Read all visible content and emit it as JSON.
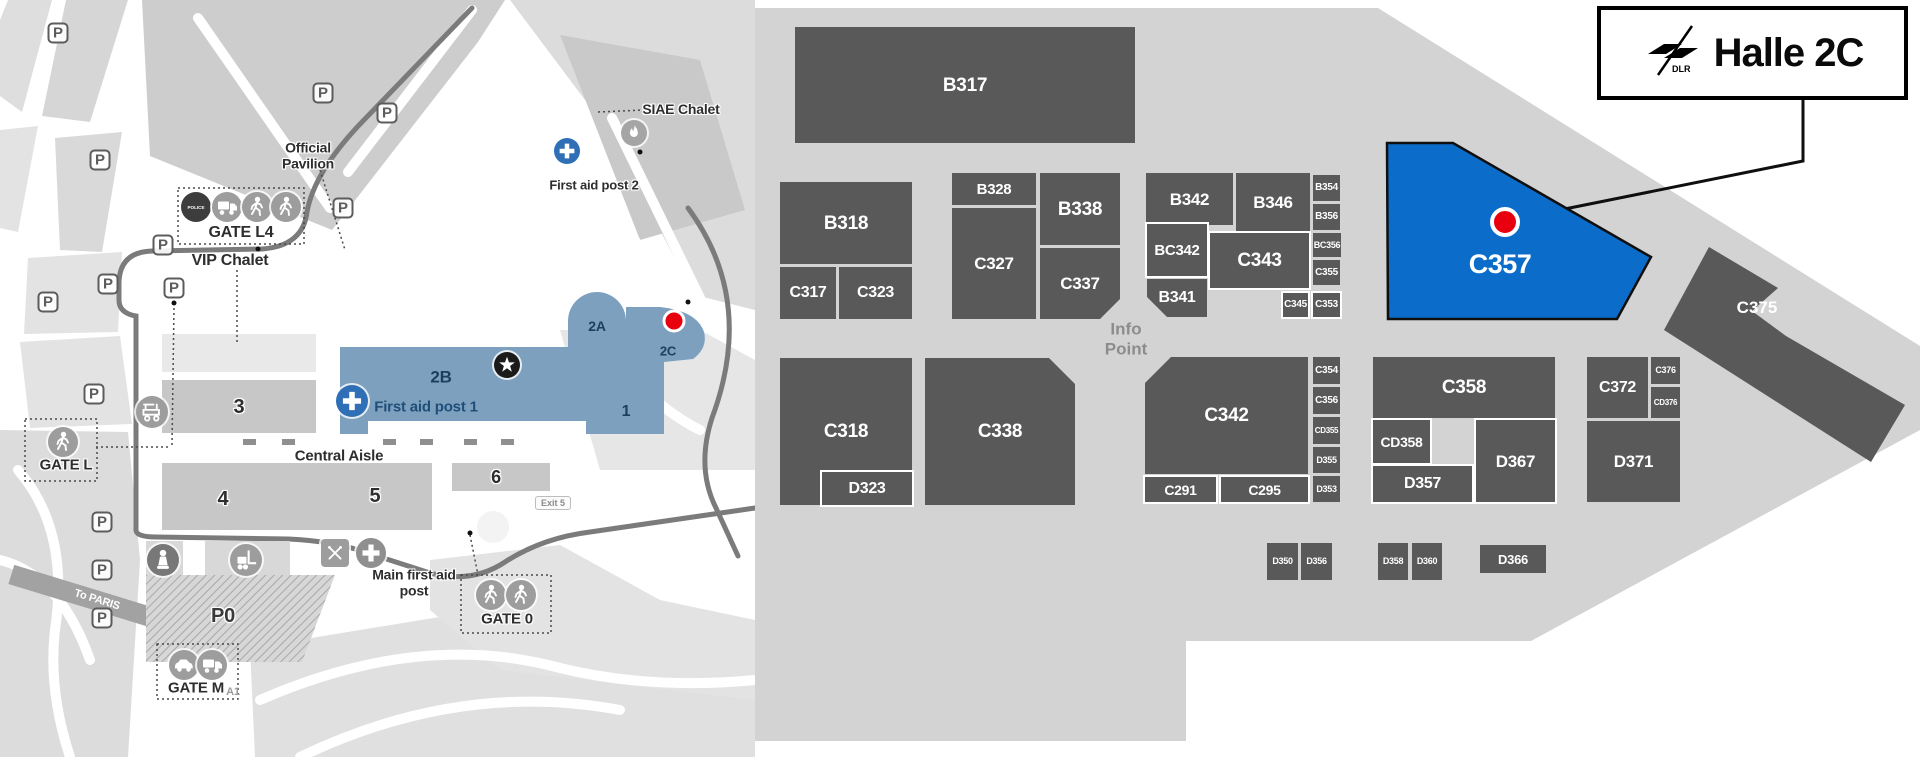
{
  "legend": {
    "title": "Halle 2C",
    "logo": "dlr-logo"
  },
  "colors": {
    "highlight": "#0b6dc9",
    "stand": "#595959",
    "panel_bg": "#d3d3d3",
    "marker_red": "#e8000f",
    "hall_blue": "#7ea0bf",
    "navy": "#1c3f5e",
    "road": "#7b7b7b",
    "hall_gray": "#c7c7c7"
  },
  "hall_map": {
    "info_point": "Info Point",
    "panel_outline": "755,8 1378,8 1920,346 1920,430 1531,641 1186,641 1186,741 755,741",
    "highlight": {
      "label": "C357",
      "points": "1387,143 1453,143 1651,257 1617,319 1388,319",
      "label_x": 1500,
      "label_y": 273,
      "marker": {
        "x": 1505,
        "y": 222,
        "r": 13
      }
    },
    "callout": "M1803,100 L1803,161 L1520,218",
    "c375": {
      "label": "C375",
      "points": "1709,247 1778,288 1752,311 1786,336 1905,405 1871,462 1664,330",
      "label_x": 1757,
      "label_y": 313
    },
    "stands": [
      {
        "l": "B317",
        "x": 795,
        "y": 27,
        "w": 340,
        "h": 116,
        "fs": 19
      },
      {
        "l": "B318",
        "x": 780,
        "y": 182,
        "w": 132,
        "h": 82,
        "fs": 19
      },
      {
        "l": "C317",
        "x": 780,
        "y": 267,
        "w": 56,
        "h": 52,
        "fs": 16
      },
      {
        "l": "C323",
        "x": 839,
        "y": 267,
        "w": 73,
        "h": 52,
        "fs": 16
      },
      {
        "l": "B328",
        "x": 952,
        "y": 173,
        "w": 84,
        "h": 32,
        "fs": 15
      },
      {
        "l": "C327",
        "x": 952,
        "y": 208,
        "w": 84,
        "h": 111,
        "fs": 17
      },
      {
        "l": "B338",
        "x": 1040,
        "y": 173,
        "w": 80,
        "h": 72,
        "fs": 19
      },
      {
        "l": "C337",
        "x": 1040,
        "y": 248,
        "w": 80,
        "h": 71,
        "fs": 17,
        "cut": "br"
      },
      {
        "l": "B342",
        "x": 1146,
        "y": 173,
        "w": 87,
        "h": 52,
        "fs": 17
      },
      {
        "l": "B346",
        "x": 1236,
        "y": 173,
        "w": 74,
        "h": 58,
        "fs": 17
      },
      {
        "l": "B354",
        "x": 1313,
        "y": 175,
        "w": 27,
        "h": 26,
        "fs": 10
      },
      {
        "l": "B356",
        "x": 1313,
        "y": 204,
        "w": 27,
        "h": 26,
        "fs": 10
      },
      {
        "l": "BC342",
        "x": 1147,
        "y": 224,
        "w": 60,
        "h": 52,
        "fs": 15,
        "b": 1
      },
      {
        "l": "C343",
        "x": 1210,
        "y": 233,
        "w": 99,
        "h": 55,
        "fs": 19,
        "b": 1
      },
      {
        "l": "B341",
        "x": 1147,
        "y": 279,
        "w": 60,
        "h": 38,
        "fs": 16,
        "cut": "bl",
        "b": 1
      },
      {
        "l": "BC356",
        "x": 1313,
        "y": 233,
        "w": 28,
        "h": 24,
        "fs": 9
      },
      {
        "l": "C355",
        "x": 1313,
        "y": 260,
        "w": 27,
        "h": 25,
        "fs": 10
      },
      {
        "l": "C345",
        "x": 1283,
        "y": 293,
        "w": 25,
        "h": 24,
        "fs": 10,
        "b": 1
      },
      {
        "l": "C353",
        "x": 1313,
        "y": 293,
        "w": 27,
        "h": 24,
        "fs": 10,
        "b": 1
      },
      {
        "l": "C318",
        "x": 780,
        "y": 358,
        "w": 132,
        "h": 147,
        "fs": 19
      },
      {
        "l": "D323",
        "x": 822,
        "y": 472,
        "w": 90,
        "h": 33,
        "fs": 16,
        "b": 1
      },
      {
        "l": "C338",
        "x": 925,
        "y": 358,
        "w": 150,
        "h": 147,
        "fs": 19,
        "cut": "tr"
      },
      {
        "l": "C342",
        "x": 1145,
        "y": 357,
        "w": 163,
        "h": 117,
        "fs": 19,
        "cut": "tl"
      },
      {
        "l": "C291",
        "x": 1145,
        "y": 477,
        "w": 71,
        "h": 25,
        "fs": 14,
        "b": 1
      },
      {
        "l": "C295",
        "x": 1221,
        "y": 477,
        "w": 87,
        "h": 25,
        "fs": 14,
        "b": 1
      },
      {
        "l": "C354",
        "x": 1313,
        "y": 357,
        "w": 27,
        "h": 27,
        "fs": 10
      },
      {
        "l": "C356",
        "x": 1313,
        "y": 387,
        "w": 27,
        "h": 27,
        "fs": 10
      },
      {
        "l": "CD355",
        "x": 1313,
        "y": 417,
        "w": 27,
        "h": 27,
        "fs": 8
      },
      {
        "l": "D355",
        "x": 1313,
        "y": 447,
        "w": 27,
        "h": 26,
        "fs": 9
      },
      {
        "l": "D353",
        "x": 1313,
        "y": 476,
        "w": 27,
        "h": 26,
        "fs": 9
      },
      {
        "l": "C358",
        "x": 1373,
        "y": 357,
        "w": 182,
        "h": 61,
        "fs": 19
      },
      {
        "l": "CD358",
        "x": 1373,
        "y": 420,
        "w": 57,
        "h": 43,
        "fs": 14,
        "b": 1
      },
      {
        "l": "D357",
        "x": 1373,
        "y": 466,
        "w": 99,
        "h": 36,
        "fs": 16,
        "b": 1
      },
      {
        "l": "D367",
        "x": 1476,
        "y": 420,
        "w": 79,
        "h": 82,
        "fs": 17,
        "b": 1
      },
      {
        "l": "C372",
        "x": 1587,
        "y": 357,
        "w": 61,
        "h": 61,
        "fs": 16
      },
      {
        "l": "C376",
        "x": 1651,
        "y": 357,
        "w": 29,
        "h": 27,
        "fs": 9
      },
      {
        "l": "CD376",
        "x": 1651,
        "y": 387,
        "w": 29,
        "h": 31,
        "fs": 8
      },
      {
        "l": "D371",
        "x": 1587,
        "y": 421,
        "w": 93,
        "h": 81,
        "fs": 17
      },
      {
        "l": "D350",
        "x": 1267,
        "y": 543,
        "w": 31,
        "h": 37,
        "fs": 9
      },
      {
        "l": "D356",
        "x": 1301,
        "y": 543,
        "w": 31,
        "h": 37,
        "fs": 9
      },
      {
        "l": "D358",
        "x": 1378,
        "y": 543,
        "w": 30,
        "h": 37,
        "fs": 9
      },
      {
        "l": "D360",
        "x": 1412,
        "y": 543,
        "w": 30,
        "h": 37,
        "fs": 9
      },
      {
        "l": "D366",
        "x": 1480,
        "y": 545,
        "w": 66,
        "h": 28,
        "fs": 13
      }
    ]
  },
  "overview_map": {
    "terrain": [
      {
        "pts": "8,0 52,0 22,112 0,96 0,20",
        "f": "#dedede"
      },
      {
        "pts": "66,0 128,0 90,122 42,116",
        "f": "#d6d6d6"
      },
      {
        "pts": "0,130 38,126 18,232 0,228"
      },
      {
        "pts": "55,138 122,132 102,252 60,250",
        "f": "#d9d9d9"
      },
      {
        "pts": "142,0 505,0 478,42 332,230 150,156",
        "f": "#cdcdcd"
      },
      {
        "pts": "510,0 755,0 755,310 695,295 600,120",
        "f": "#dcdcdc"
      },
      {
        "pts": "560,35 700,60 745,210 640,240",
        "f": "#c9c9c9"
      },
      {
        "pts": "28,258 122,252 118,332 24,334"
      },
      {
        "pts": "20,342 120,336 132,424 30,428"
      },
      {
        "pts": "0,430 128,432 140,560 128,757 0,757",
        "f": "#dcdcdc"
      },
      {
        "pts": "250,648 470,612 660,680 755,700 755,757 255,757",
        "f": "#e0e0e0"
      },
      {
        "pts": "430,560 560,545 660,600 755,620 755,700 500,670 430,610"
      },
      {
        "pts": "560,330 700,330 755,360 755,470 600,470",
        "f": "#e6e6e6"
      }
    ],
    "white_roads": [
      "M198,18 L330,208",
      "M472,10 L348,172",
      "M612,118 L700,298",
      "M540,60 L640,250",
      "M18,470 Q70,530 55,630 Q48,690 70,757",
      "M0,560 Q60,575 90,660",
      "M260,700 Q420,630 560,668 Q650,690 755,680",
      "M300,757 Q460,680 620,710",
      "M600,330 Q640,400 700,430"
    ],
    "bands": [
      {
        "x": 95,
        "y": 600,
        "w": 175,
        "h": 20,
        "rot": 17,
        "f": "#a2a2a2"
      }
    ],
    "dark_roads": [
      "M472,8 L362,122 Q314,172 307,212 Q303,246 262,249 L152,251 Q120,252 119,282 L119,300 Q119,313 136,316 L136,530 Q136,537 156,537 L288,539 Q334,541 368,553 L430,573 Q472,584 505,562 Q542,538 590,532 L755,508",
      "M688,208 Q756,300 712,418 Q696,468 716,508 L738,556"
    ],
    "halls": [
      {
        "x": 162,
        "y": 334,
        "w": 154,
        "h": 38,
        "f": "#e9e9e9"
      },
      {
        "x": 162,
        "y": 380,
        "w": 154,
        "h": 53
      },
      {
        "x": 162,
        "y": 463,
        "w": 270,
        "h": 67
      },
      {
        "x": 452,
        "y": 463,
        "w": 98,
        "h": 28
      },
      {
        "x": 146,
        "y": 541,
        "w": 37,
        "h": 38,
        "f": "#d8d8d8"
      },
      {
        "x": 205,
        "y": 541,
        "w": 85,
        "h": 38,
        "f": "#d8d8d8"
      }
    ],
    "p0_area": "146,575 335,575 302,662 146,662",
    "blue_complex": {
      "path": "M340,347 L568,347 L568,321 A29,29 0 0 1 626,321 L626,307 L660,307 Q697,311 704,332 Q708,348 693,359 L664,362 L664,434 L586,434 L586,421 L368,421 L368,434 L340,434 Z",
      "red_dot": {
        "x": 674,
        "y": 321,
        "r": 10
      }
    },
    "aisle_ticks": {
      "y": 439,
      "xs": [
        243,
        282,
        383,
        420,
        464,
        501
      ],
      "w": 13,
      "h": 6
    },
    "roundabout": {
      "x": 493,
      "y": 527,
      "r": 16
    },
    "dotted_lines": [
      "M598,112 L644,110",
      "M320,170 L345,250",
      "M237,270 L237,345",
      "M470,535 L478,575",
      "M96,447 L170,447",
      "M172,445 L174,307"
    ],
    "dots": [
      [
        174,
        303
      ],
      [
        470,
        533
      ],
      [
        688,
        302
      ],
      [
        640,
        152
      ],
      [
        258,
        249
      ]
    ],
    "gates": [
      {
        "id": "gate-l4",
        "box": [
          178,
          188,
          126,
          56
        ],
        "icons": [
          {
            "t": "police",
            "x": 196,
            "y": 207
          },
          {
            "t": "truck",
            "x": 227,
            "y": 207
          },
          {
            "t": "ped",
            "x": 257,
            "y": 207
          },
          {
            "t": "ped",
            "x": 286,
            "y": 207
          }
        ]
      },
      {
        "id": "gate-l",
        "box": [
          25,
          419,
          72,
          62
        ],
        "icons": [
          {
            "t": "ped",
            "x": 63,
            "y": 442
          }
        ]
      },
      {
        "id": "gate-0",
        "box": [
          461,
          575,
          90,
          58
        ],
        "icons": [
          {
            "t": "ped",
            "x": 491,
            "y": 595
          },
          {
            "t": "ped",
            "x": 521,
            "y": 595
          }
        ]
      },
      {
        "id": "gate-m",
        "box": [
          157,
          644,
          81,
          55
        ],
        "icons": [
          {
            "t": "car",
            "x": 184,
            "y": 665
          },
          {
            "t": "truck",
            "x": 212,
            "y": 665
          }
        ]
      }
    ],
    "icons": [
      {
        "t": "flame",
        "x": 634,
        "y": 133,
        "r": 13
      },
      {
        "t": "cross",
        "x": 567,
        "y": 151,
        "r": 13
      },
      {
        "t": "buggy",
        "x": 152,
        "y": 412,
        "r": 16
      },
      {
        "t": "statue",
        "x": 163,
        "y": 560,
        "r": 16
      },
      {
        "t": "forklift",
        "x": 246,
        "y": 560,
        "r": 16
      },
      {
        "t": "utensils",
        "x": 335,
        "y": 553,
        "r": 14
      },
      {
        "t": "crossg",
        "x": 371,
        "y": 553,
        "r": 15
      },
      {
        "t": "star",
        "x": 507,
        "y": 365,
        "r": 13
      },
      {
        "t": "cross",
        "x": 352,
        "y": 401,
        "r": 16
      }
    ],
    "parking": [
      [
        58,
        33
      ],
      [
        323,
        93
      ],
      [
        387,
        113
      ],
      [
        100,
        160
      ],
      [
        343,
        208
      ],
      [
        163,
        245
      ],
      [
        108,
        284
      ],
      [
        174,
        288
      ],
      [
        48,
        302
      ],
      [
        94,
        394
      ],
      [
        102,
        522
      ],
      [
        102,
        570
      ],
      [
        102,
        618
      ]
    ],
    "parking_symbol": "P",
    "labels": [
      {
        "t": "Official Pavilion",
        "x": 308,
        "y": 156,
        "fs": 14,
        "w": 88
      },
      {
        "t": "GATE L4",
        "x": 241,
        "y": 233,
        "fs": 16
      },
      {
        "t": "VIP Chalet",
        "x": 230,
        "y": 261,
        "fs": 16
      },
      {
        "t": "SIAE Chalet",
        "x": 681,
        "y": 110,
        "fs": 14
      },
      {
        "t": "First aid post 2",
        "x": 594,
        "y": 186,
        "fs": 13
      },
      {
        "t": "Central Aisle",
        "x": 339,
        "y": 457,
        "fs": 15
      },
      {
        "t": "Main first aid post",
        "x": 414,
        "y": 583,
        "fs": 14,
        "w": 112
      },
      {
        "t": "GATE L",
        "x": 66,
        "y": 466,
        "fs": 15
      },
      {
        "t": "GATE 0",
        "x": 507,
        "y": 620,
        "fs": 15
      },
      {
        "t": "GATE M",
        "x": 196,
        "y": 689,
        "fs": 15
      },
      {
        "t": "P0",
        "x": 223,
        "y": 616,
        "fs": 20,
        "c": "#3a3a3a"
      },
      {
        "t": "3",
        "x": 239,
        "y": 407,
        "fs": 20
      },
      {
        "t": "4",
        "x": 223,
        "y": 499,
        "fs": 20
      },
      {
        "t": "5",
        "x": 375,
        "y": 496,
        "fs": 20
      },
      {
        "t": "6",
        "x": 496,
        "y": 477,
        "fs": 18
      },
      {
        "t": "A1",
        "x": 233,
        "y": 692,
        "fs": 11,
        "c": "#9b9b9b",
        "nh": 1
      },
      {
        "t": "To PARIS",
        "x": 97,
        "y": 600,
        "fs": 11,
        "c": "#ffffff",
        "rot": 17,
        "nh": 1
      },
      {
        "t": "2A",
        "x": 597,
        "y": 327,
        "fs": 14,
        "c": "#1c3f5e",
        "nh": 1
      },
      {
        "t": "2B",
        "x": 441,
        "y": 377,
        "fs": 17,
        "c": "#1c3f5e",
        "nh": 1
      },
      {
        "t": "2C",
        "x": 668,
        "y": 352,
        "fs": 13,
        "c": "#1c3f5e",
        "nh": 1
      },
      {
        "t": "1",
        "x": 626,
        "y": 412,
        "fs": 16,
        "c": "#1c3f5e",
        "nh": 1
      },
      {
        "t": "First aid post 1",
        "x": 426,
        "y": 408,
        "fs": 15,
        "c": "#1f4e79",
        "nh": 1
      }
    ],
    "exit_badge": {
      "t": "Exit 5",
      "x": 553,
      "y": 503
    }
  }
}
